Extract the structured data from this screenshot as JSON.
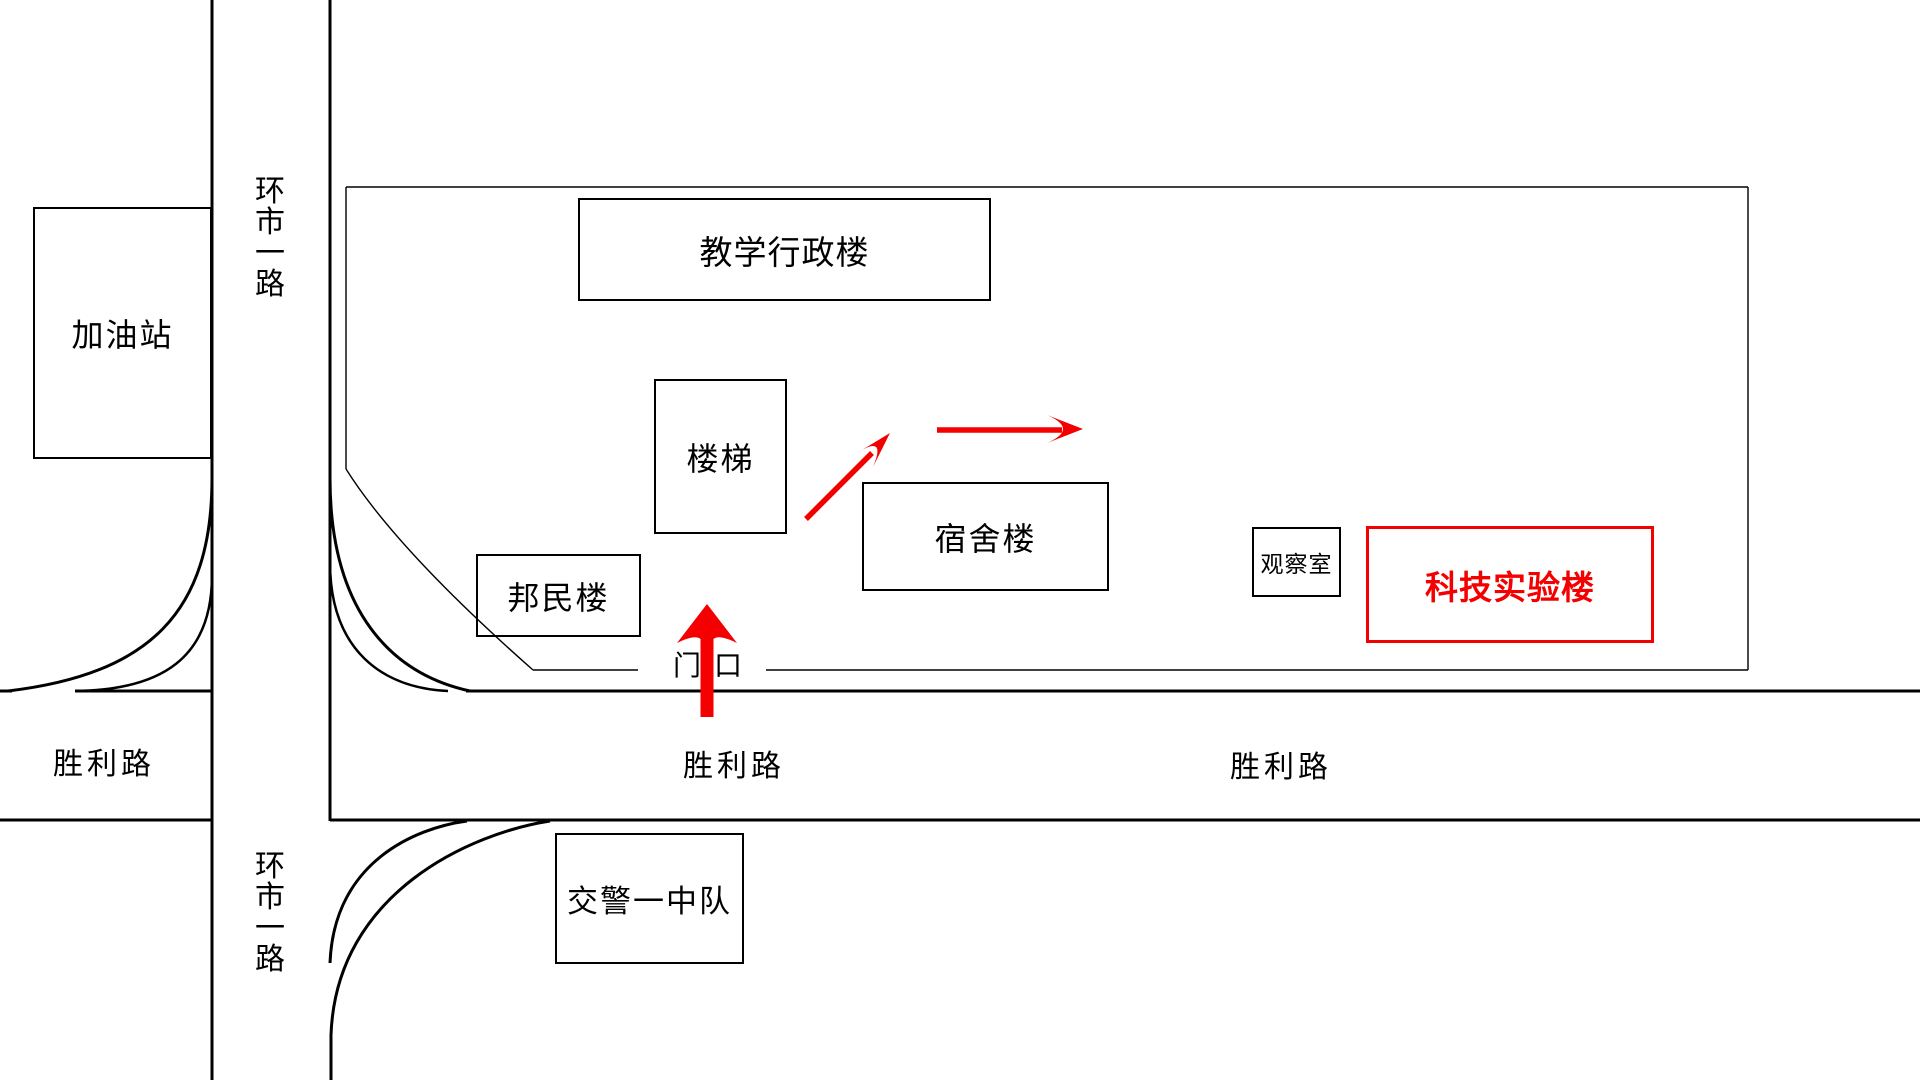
{
  "map_title": "campus location sketch map",
  "roads": {
    "huanshi_top": {
      "label": "环市一路"
    },
    "huanshi_bottom": {
      "label": "环市一路"
    },
    "shengli_west": {
      "label": "胜利路"
    },
    "shengli_center": {
      "label": "胜利路"
    },
    "shengli_east": {
      "label": "胜利路"
    }
  },
  "buildings": {
    "gas_station": {
      "label": "加油站"
    },
    "teaching_admin": {
      "label": "教学行政楼"
    },
    "stairs": {
      "label": "楼梯"
    },
    "bangmin": {
      "label": "邦民楼"
    },
    "dormitory": {
      "label": "宿舍楼"
    },
    "observation_room": {
      "label": "观察室"
    },
    "science_lab": {
      "label": "科技实验楼"
    },
    "traffic_police": {
      "label": "交警一中队"
    }
  },
  "gate": {
    "label": "门口"
  },
  "route_arrows": [
    {
      "direction": "up"
    },
    {
      "direction": "up-right"
    },
    {
      "direction": "right"
    }
  ],
  "colors": {
    "ink": "#000000",
    "route": "#f40000",
    "background": "#ffffff"
  }
}
